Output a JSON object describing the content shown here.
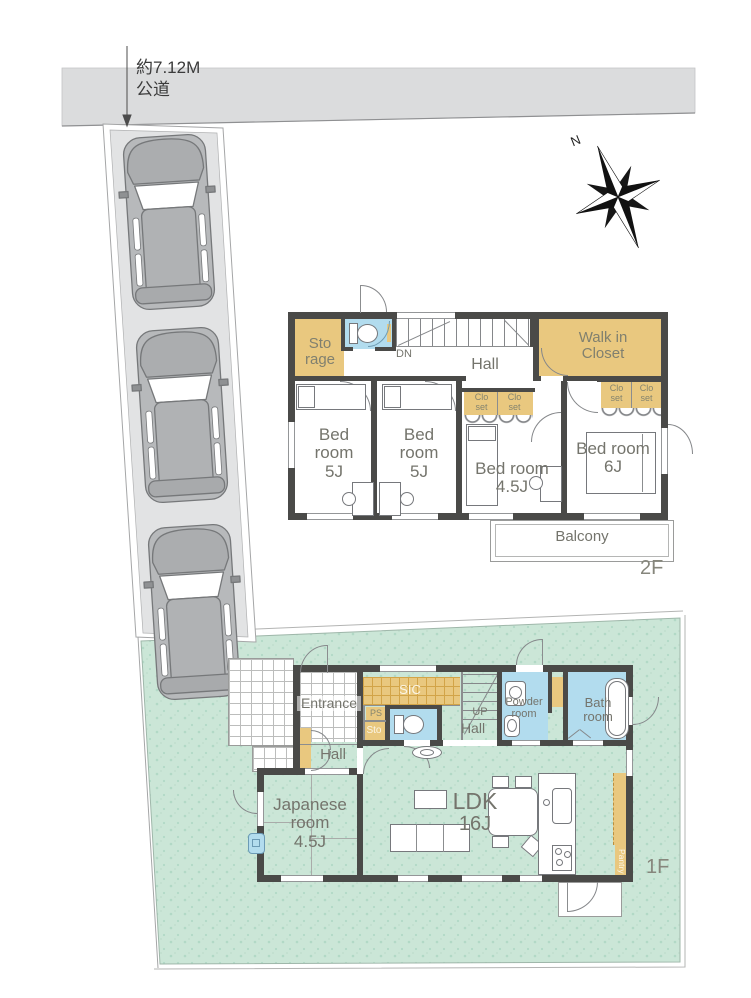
{
  "site": {
    "road_label": [
      "約7.12M",
      "公道"
    ],
    "compass_n": "N"
  },
  "floor2": {
    "floor_label": "2F",
    "storage": [
      "Sto",
      "rage"
    ],
    "dn": "DN",
    "hall": "Hall",
    "walk_in_closet": [
      "Walk in",
      "Closet"
    ],
    "closet": [
      "Clo",
      "set"
    ],
    "bedroom_a": [
      "Bed",
      "room",
      "5J"
    ],
    "bedroom_b": [
      "Bed",
      "room",
      "5J"
    ],
    "bedroom_c": [
      "Bed room",
      "4.5J"
    ],
    "bedroom_d": [
      "Bed room",
      "6J"
    ],
    "balcony": "Balcony"
  },
  "floor1": {
    "floor_label": "1F",
    "entrance": "Entrance",
    "sic": "SIC",
    "ps": "PS",
    "sto": "Sto",
    "up": "UP",
    "hall_stairs": "Hall",
    "hall_entry": "Hall",
    "powder_room": [
      "Powder",
      "room"
    ],
    "bath_room": [
      "Bath",
      "room"
    ],
    "ldk": [
      "LDK",
      "16J"
    ],
    "japanese_room": [
      "Japanese",
      "room",
      "4.5J"
    ],
    "pantry": "Pantry"
  },
  "colors": {
    "wall": "#4a4a48",
    "tan": "#e9c87f",
    "blue": "#b2dcee",
    "lawn_green": "#cbe6d7",
    "road_gray": "#dbdcdd",
    "car_gray": "#b7b9bb",
    "label_gray": "#74746c"
  }
}
